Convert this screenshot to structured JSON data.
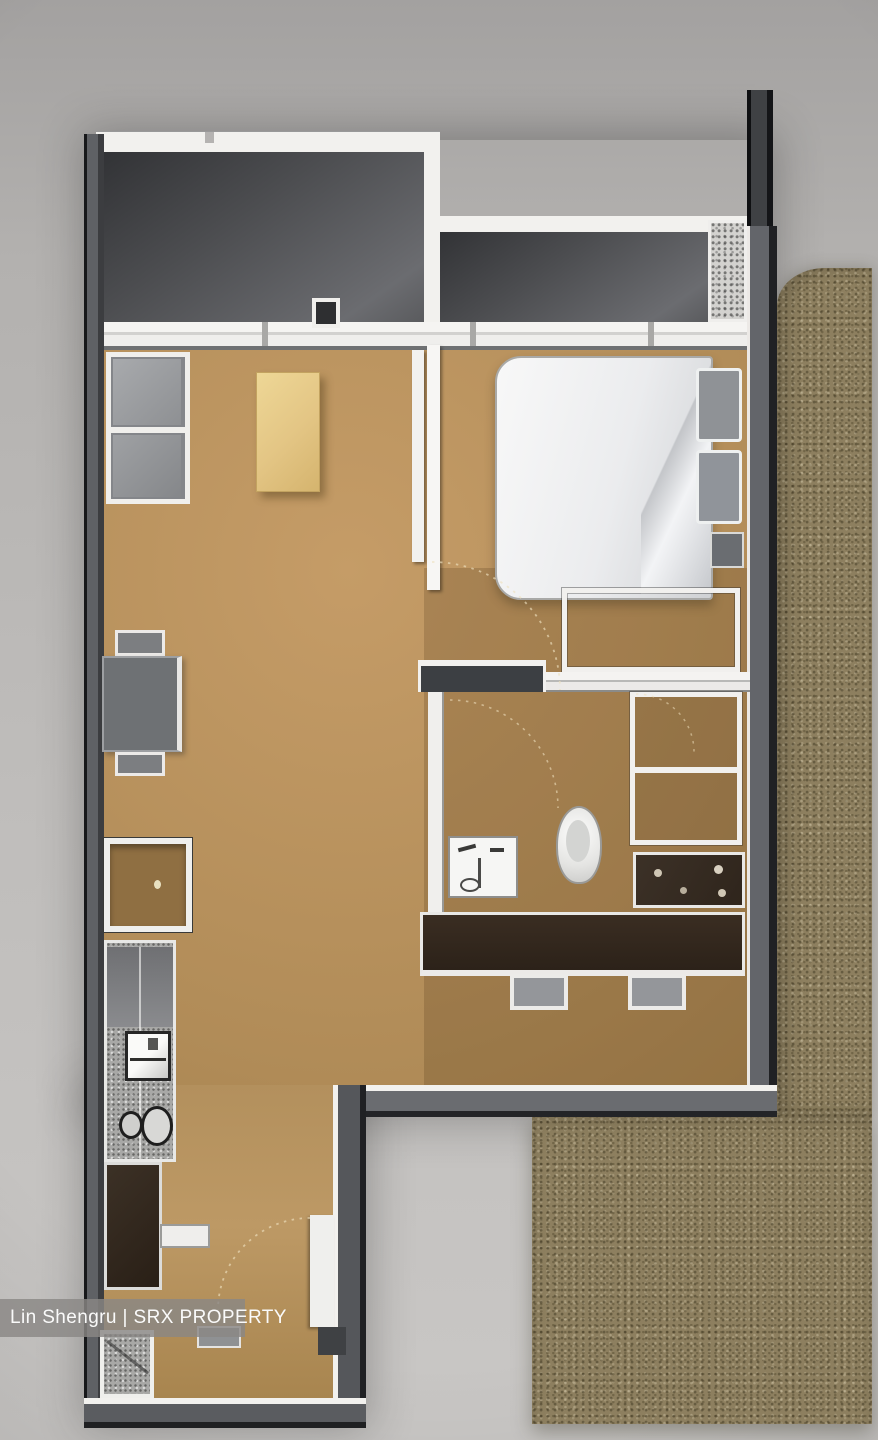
{
  "watermark": {
    "text": "Lin Shengru | SRX PROPERTY"
  },
  "floorplan": {
    "description": "3D rendered top-down floor plan of a one-bedroom apartment unit with side balcony terrace",
    "rooms": [
      {
        "name": "aircon-ledge-left"
      },
      {
        "name": "aircon-ledge-right"
      },
      {
        "name": "living-dining-area"
      },
      {
        "name": "bedroom"
      },
      {
        "name": "walk-in-wardrobe"
      },
      {
        "name": "bathroom"
      },
      {
        "name": "kitchen-corridor"
      },
      {
        "name": "balcony-terrace"
      }
    ],
    "furniture": [
      "shelf-console",
      "coffee-table",
      "dining-table",
      "dining-chairs",
      "double-bed",
      "pillows",
      "nightstand",
      "wardrobe-cabinet",
      "vanity-sink",
      "toilet",
      "shower-enclosure",
      "bathroom-counter",
      "kitchen-island",
      "kitchen-sink",
      "hob-burners",
      "refrigerator",
      "washing-machine",
      "stools"
    ]
  },
  "colors": {
    "background": "#b7b5b3",
    "floor": "#b18c58",
    "wall_white": "#f2f1ee",
    "wall_gray": "#5d5f63",
    "wall_edge": "#1d1e20",
    "void_room": "#48494c",
    "carpet": "#8d7f5f",
    "bed": "#ebecee",
    "pillow": "#8f9296",
    "table_yellow": "#e5c985",
    "furniture_gray": "#6f7275",
    "cabinet_dark": "#342a20",
    "counter_light": "#a7a7a5"
  }
}
